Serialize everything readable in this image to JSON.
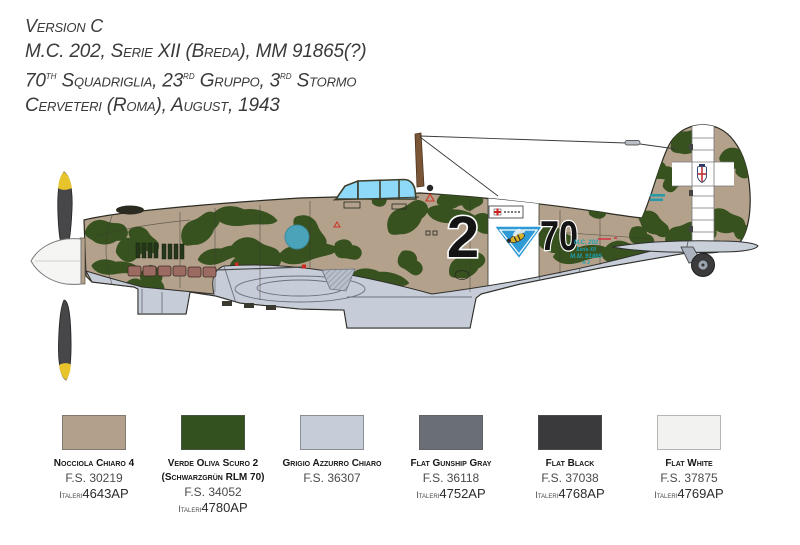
{
  "header": {
    "line1": "Version C",
    "line2": "M.C. 202, Serie XII (Breda), MM 91865(?)",
    "line3_parts": [
      "70",
      "th",
      " Squadriglia, 23",
      "rd",
      " Gruppo, 3",
      "rd",
      " Stormo"
    ],
    "line4": "Cerveteri (Roma), August, 1943"
  },
  "aircraft": {
    "fuselage_number_left": "2",
    "fuselage_number_right": "70",
    "stencil_lines": [
      "M.C. 202",
      "Serie XII",
      "M.M. 91865",
      "A 3"
    ],
    "palette": {
      "camo_tan": "#b3a18c",
      "camo_green": "#37521f",
      "underside_gray": "#c6cdd8",
      "canopy_blue": "#8ed9f7",
      "band_white": "#ffffff",
      "badge_blue": "#2e9ad6",
      "propeller_dark": "#47474a",
      "propeller_tip_yellow": "#e7c42c",
      "spinner_white": "#f5f5f3",
      "exhaust_brown": "#9b6b61",
      "stencil_teal": "#1f9fae",
      "roundel_disc_teal": "#4aa3b8"
    }
  },
  "swatches": [
    {
      "name": "Nocciola Chiaro 4",
      "name2": "",
      "fs": "F.S. 30219",
      "brand": "Italeri",
      "code": "4643AP",
      "hex": "#b3a08c"
    },
    {
      "name": "Verde Oliva Scuro 2",
      "name2": "(Schwarzgrün RLM 70)",
      "fs": "F.S. 34052",
      "brand": "Italeri",
      "code": "4780AP",
      "hex": "#33511f"
    },
    {
      "name": "Grigio Azzurro Chiaro",
      "name2": "",
      "fs": "F.S. 36307",
      "hex": "#c6cdd8"
    },
    {
      "name": "Flat Gunship Gray",
      "name2": "",
      "fs": "F.S. 36118",
      "brand": "Italeri",
      "code": "4752AP",
      "hex": "#6a6e76"
    },
    {
      "name": "Flat Black",
      "name2": "",
      "fs": "F.S. 37038",
      "brand": "Italeri",
      "code": "4768AP",
      "hex": "#3a3a3c"
    },
    {
      "name": "Flat White",
      "name2": "",
      "fs": "F.S. 37875",
      "brand": "Italeri",
      "code": "4769AP",
      "hex": "#f2f2f0"
    }
  ]
}
